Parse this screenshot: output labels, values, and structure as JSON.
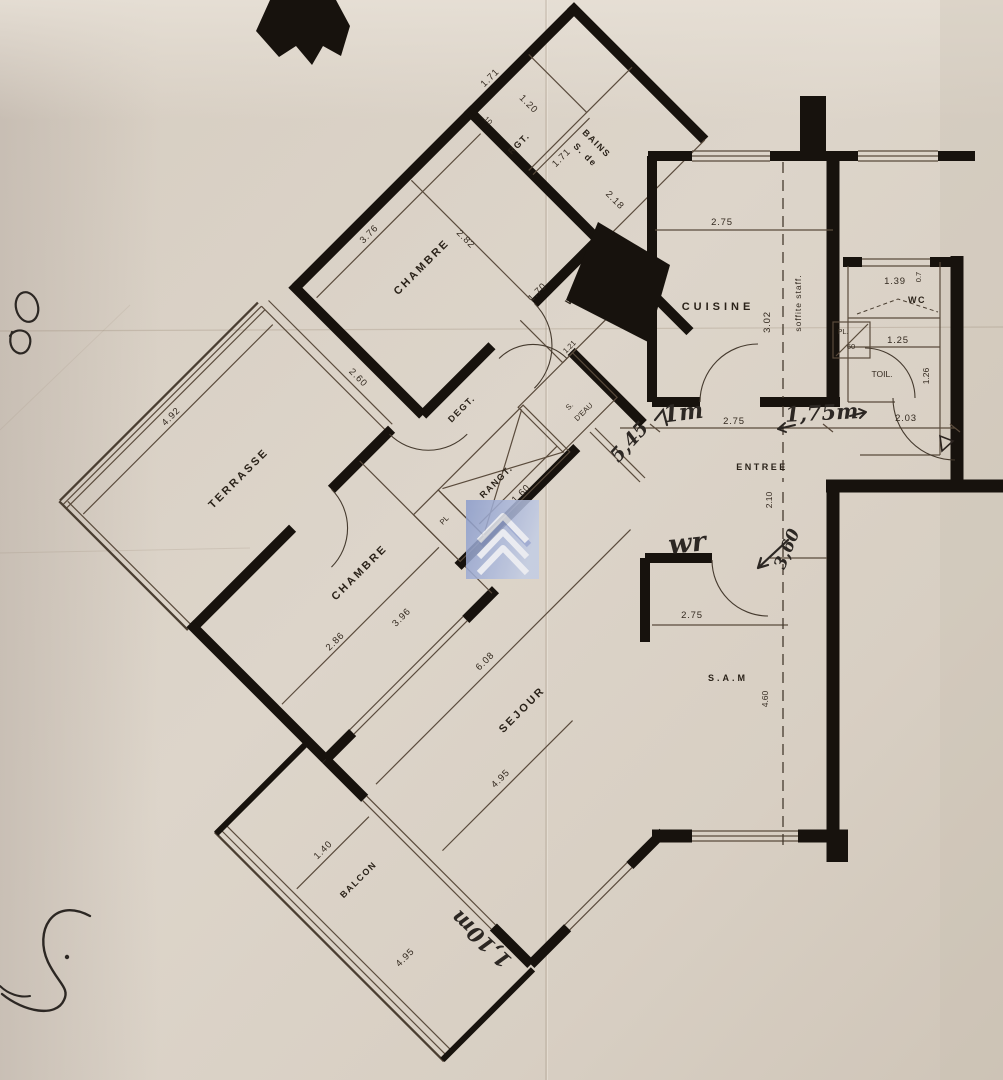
{
  "document": {
    "kind": "scanned architectural floor plan",
    "language": "French",
    "wings": [
      "diagonal wing (terrasse, chambres, sejour, balcon)",
      "orthogonal wing (cuisine, entree, s.a.m, wc)"
    ]
  },
  "colors": {
    "paper": "#ddd5ca",
    "paper_shadow": "#c9bfb2",
    "wall_ink": "#17120d",
    "print_ink": "#2a2219",
    "handwriting_ink": "#2c2723",
    "logo_blue": "#8b9ccb",
    "logo_blue_light": "#c3cde5",
    "logo_chevron": "#edf0f8"
  },
  "rooms": {
    "terrasse": "TERRASSE",
    "chambre1": "CHAMBRE",
    "rangement": "RGT.",
    "bains_line1": "S. de",
    "bains_line2": "BAINS",
    "wc_diag": "WC",
    "eau_line1": "S.",
    "eau_line2": "D'EAU",
    "degagement": "DEGT.",
    "rangt": "RANGT.",
    "placard": "PL",
    "chambre2": "CHAMBRE",
    "sejour": "SEJOUR",
    "balcon": "BALCON",
    "cuisine": "CUISINE",
    "soffite": "soffite staff.",
    "wc_right": "WC",
    "placard2": "PL.",
    "toilette": "TOIL.",
    "entree": "ENTREE",
    "salle_a_manger": "S.A.M"
  },
  "dims": {
    "chambre1_w": "3.76",
    "chambre1_d": "2.82",
    "rgt_top": "1.71",
    "rgt_w": "1.20",
    "rgt_s": ".10",
    "rgt_b": "1.71",
    "bains": "2.18",
    "wc_w": "1.70",
    "wc_d": ".90",
    "eau": "1.21",
    "terrasse_d": "2.60",
    "terrasse_w": "4.92",
    "chambre2_d": "2.86",
    "chambre2_w": "3.96",
    "rangt": "1.60",
    "sejour_l": "6.08",
    "sejour_w": "4.95",
    "balcon_d": "1.40",
    "balcon_l": "4.95",
    "cuisine_w": "2.75",
    "cuisine_d": "3.02",
    "wc2_w": "1.39",
    "wc2_s": "0.7",
    "toil_w": "1.25",
    "toil_d": "1.26",
    "pl2": "60",
    "entree_l": "2.75",
    "entree_r": "2.03",
    "entree_d": "2.10",
    "sam_w": "2.75",
    "sam_d": "4.60"
  },
  "handwritten": {
    "note_wr": "wr",
    "note_545": "5,45",
    "note_1m": "1m",
    "note_175": "1,75m",
    "note_360": "3,60",
    "note_110": "1,10m"
  }
}
